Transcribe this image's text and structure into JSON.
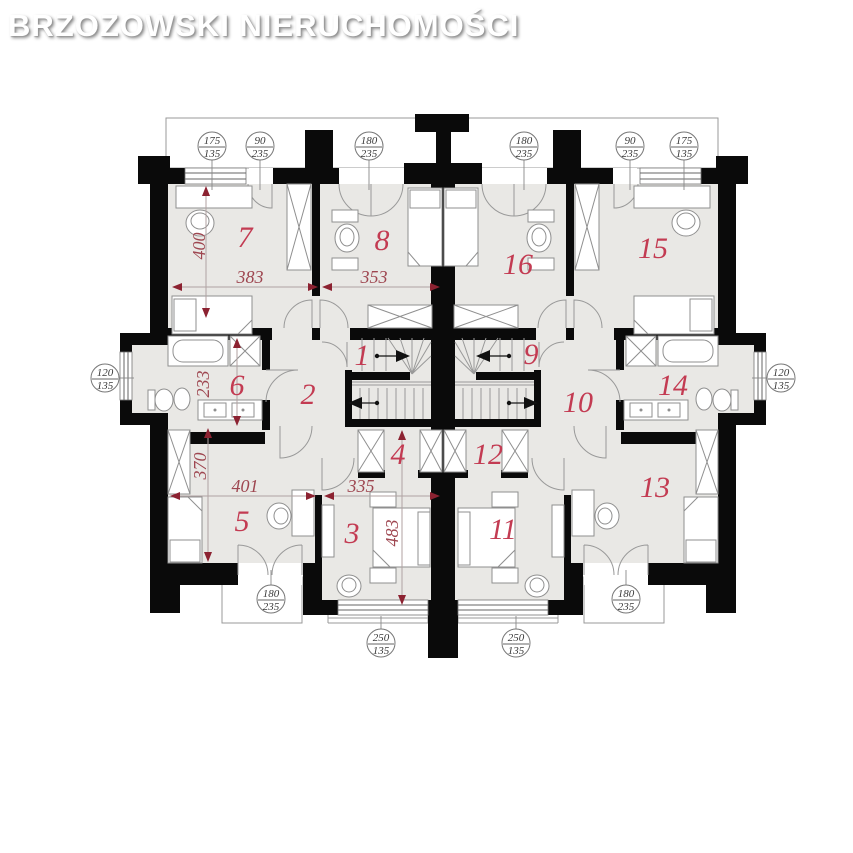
{
  "watermark": "BRZOZOWSKI NIERUCHOMOŚCI",
  "colors": {
    "wall_black": "#0a0a0a",
    "room_fill": "#e9e8e5",
    "room_number_red": "#c33b52",
    "dimension_red": "#9e4650"
  },
  "rooms": [
    {
      "number": "1"
    },
    {
      "number": "2"
    },
    {
      "number": "3"
    },
    {
      "number": "4"
    },
    {
      "number": "5"
    },
    {
      "number": "6"
    },
    {
      "number": "7"
    },
    {
      "number": "8"
    },
    {
      "number": "9"
    },
    {
      "number": "10"
    },
    {
      "number": "11"
    },
    {
      "number": "12"
    },
    {
      "number": "13"
    },
    {
      "number": "14"
    },
    {
      "number": "15"
    },
    {
      "number": "16"
    }
  ],
  "dimensions": [
    {
      "value": "400"
    },
    {
      "value": "383"
    },
    {
      "value": "353"
    },
    {
      "value": "233"
    },
    {
      "value": "370"
    },
    {
      "value": "401"
    },
    {
      "value": "335"
    },
    {
      "value": "483"
    }
  ],
  "window_callouts": [
    {
      "w": "175",
      "h": "135"
    },
    {
      "w": "90",
      "h": "235"
    },
    {
      "w": "180",
      "h": "235"
    },
    {
      "w": "180",
      "h": "235"
    },
    {
      "w": "90",
      "h": "235"
    },
    {
      "w": "175",
      "h": "135"
    },
    {
      "w": "120",
      "h": "135"
    },
    {
      "w": "120",
      "h": "135"
    },
    {
      "w": "180",
      "h": "235"
    },
    {
      "w": "250",
      "h": "135"
    },
    {
      "w": "250",
      "h": "135"
    },
    {
      "w": "180",
      "h": "235"
    }
  ]
}
